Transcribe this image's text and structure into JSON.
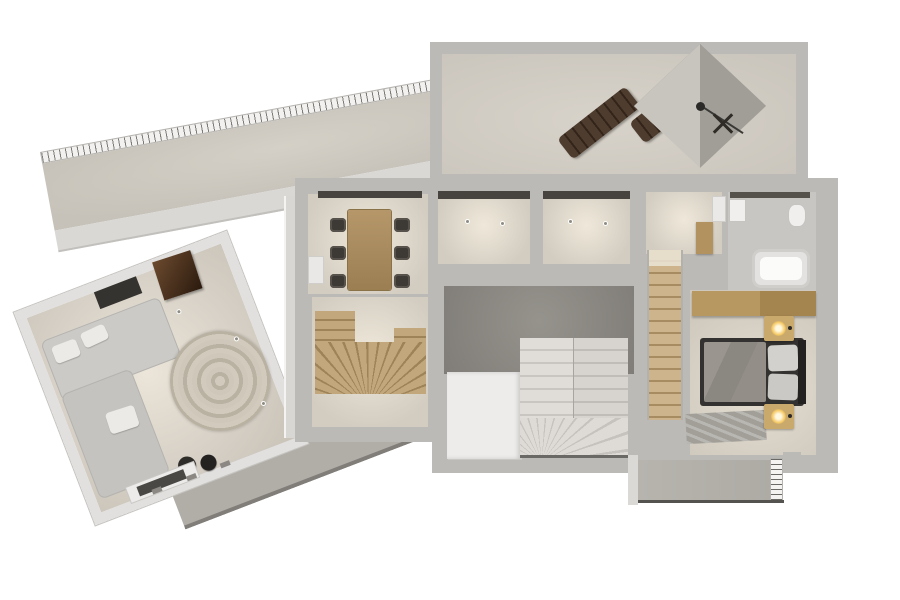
{
  "scene": {
    "type": "3d-floor-plan-top-view",
    "background": "#ffffff",
    "visible_text": "none"
  },
  "palette": {
    "wall": "#bcbab7",
    "wall_light": "#dad9d6",
    "floor_beige": "#d7d2c9",
    "floor_lit": "#efe8da",
    "terrace_gray": "#b1aea8",
    "stairhall_dark": "#8a8783",
    "bathroom_floor": "#c8c6c3",
    "wood": "#b2925f",
    "stair_wood": "#a78c62",
    "stair_white": "#dedbd6",
    "furniture_dark": "#3d3935",
    "lounger_brown": "#4e3c2e",
    "bed_frame": "#343230",
    "blanket_gray": "#8f8c86",
    "lamp_glow": "#f5c964",
    "railing_hatch": "#6b6966",
    "parasol_faces": [
      "#8f8c87",
      "#a19e98",
      "#dcd9d4",
      "#c8c4be"
    ]
  },
  "rooms": {
    "upper_terrace": {
      "label": "Roof terrace with parasol and two sun loungers"
    },
    "side_balcony": {
      "label": "Slanted side balcony with hatched railing"
    },
    "living_room": {
      "label": "Living room with corner sofa, round rug, fireplace, TV"
    },
    "dining_room": {
      "label": "Dining room with table for six"
    },
    "storage_a": {
      "label": "Lit storage room A with two ceiling spotlights"
    },
    "storage_b": {
      "label": "Lit storage room B with two ceiling spotlights"
    },
    "hallway": {
      "label": "Hallway landing with wall shelf"
    },
    "bathroom": {
      "label": "Bathroom with bathtub, toilet and sink"
    },
    "stair_hall": {
      "label": "Stair hall with white winder staircase and closet block"
    },
    "wood_stair_room": {
      "label": "Wooden winder staircase room"
    },
    "straight_stair": {
      "label": "Straight wooden staircase"
    },
    "bedroom": {
      "label": "Bedroom with double bed, nightstands and wardrobe"
    },
    "lower_terrace": {
      "label": "Lower slanted terrace"
    },
    "rear_balcony": {
      "label": "Rear balcony with hatched railing"
    }
  },
  "furniture": {
    "parasol": 1,
    "sun_loungers": 2,
    "folding_chair": 1,
    "corner_sofa": 1,
    "sofa_pillows": 3,
    "round_rug": 1,
    "fireplace_cube": 1,
    "wall_tv": 1,
    "poufs": 2,
    "tv_console": 1,
    "dining_table": 1,
    "dining_chairs": 6,
    "sideboard": 1,
    "ceiling_spotlights": 4,
    "bathtub": 1,
    "toilet": 1,
    "sink": 1,
    "wall_shelf": 1,
    "double_bed": 1,
    "bed_pillows": 2,
    "nightstands": 2,
    "lamps": 2,
    "bedroom_rug": 1,
    "wardrobe": 1,
    "closet_block": 1
  }
}
